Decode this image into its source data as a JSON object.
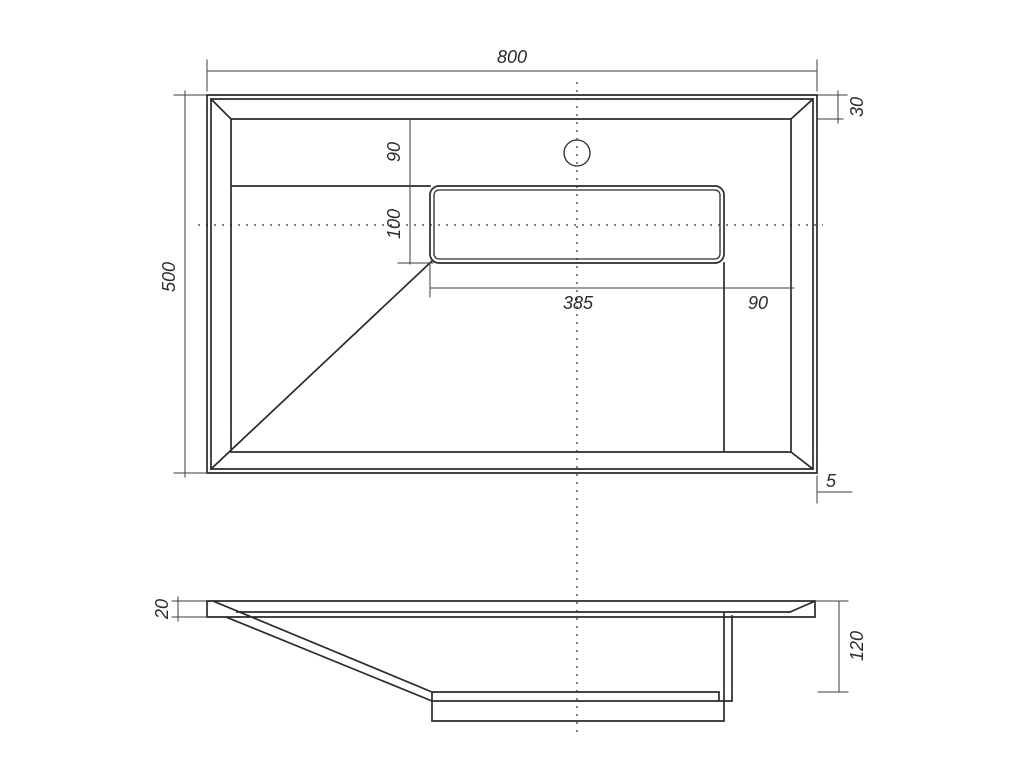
{
  "drawing": {
    "type": "technical-dimension-drawing",
    "subject": "rectangular washbasin, top view and side section",
    "background_color": "#ffffff",
    "line_color": "#2b2b2b",
    "dimension_line_color": "#3c3c3c",
    "dimensions": {
      "overall_width": "800",
      "rim_width": "30",
      "overall_depth": "500",
      "deck_depth": "90",
      "slot_depth": "100",
      "slot_width": "385",
      "slot_side_offset": "90",
      "rim_edge": "5",
      "deck_thickness": "20",
      "bowl_height": "120"
    }
  }
}
